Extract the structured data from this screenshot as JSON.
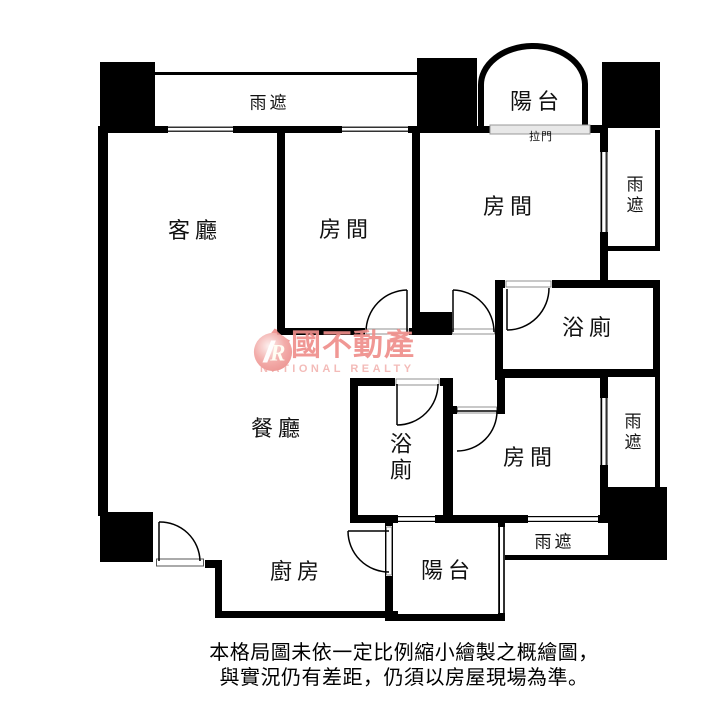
{
  "canvas": {
    "width": 722,
    "height": 709,
    "background": "#ffffff",
    "wall_color": "#000000",
    "sliding_door_fill": "#e8e8e8"
  },
  "labels": {
    "living": "客廳",
    "dining": "餐廳",
    "kitchen": "廚房",
    "bedroom_top_middle": "房間",
    "bedroom_top_right": "房間",
    "bedroom_bottom_right": "房間",
    "bathroom_master": "浴廁",
    "bathroom_small": "浴廁",
    "balcony_top": "陽台",
    "balcony_bottom": "陽台",
    "canopy_top": "雨遮",
    "canopy_right_upper": "雨遮",
    "canopy_right_lower": "雨遮",
    "canopy_bottom": "雨遮",
    "sliding_door": "拉門"
  },
  "watermark": {
    "logo_letter": "R",
    "brand": "全國不動產",
    "brand_en": "NATIONAL REALTY",
    "brand_color": "#ef8f8b",
    "brand_en_color": "#f3b6b3"
  },
  "disclaimer": {
    "line1": "本格局圖未依一定比例縮小繪製之概繪圖，",
    "line2": "與實況仍有差距，仍須以房屋現場為準。"
  }
}
